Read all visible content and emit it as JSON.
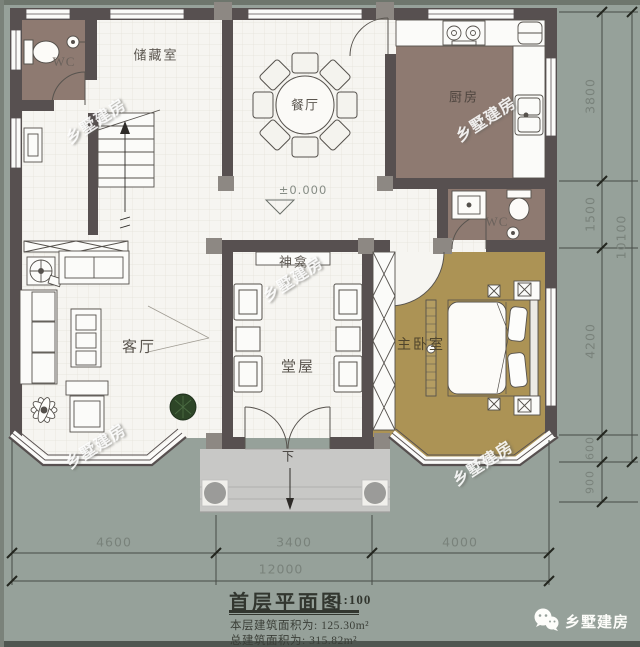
{
  "rooms": {
    "wc_upper": {
      "label": "WC"
    },
    "storage": {
      "label": "储藏室"
    },
    "dining": {
      "label": "餐厅"
    },
    "kitchen": {
      "label": "厨房"
    },
    "wc_master": {
      "label": "WC"
    },
    "shrine": {
      "label": "神龛"
    },
    "hall": {
      "label": "堂屋"
    },
    "living": {
      "label": "客厅"
    },
    "master_bedroom": {
      "label": "主卧室"
    }
  },
  "markers": {
    "level": "±0.000",
    "entry_down": "下"
  },
  "dimensions": {
    "bottom": {
      "segments": [
        "4600",
        "3400",
        "4000"
      ],
      "total": "12000"
    },
    "right": {
      "segments": [
        "3800",
        "1500",
        "4200",
        "600",
        "900"
      ],
      "total": "10100"
    }
  },
  "title_block": {
    "title": "首层平面图",
    "scale": "1:100",
    "floor_area": "本层建筑面积为: 125.30m²",
    "total_area": "总建筑面积为: 315.82m²"
  },
  "watermark": {
    "text": "乡墅建房"
  },
  "logo": {
    "text": "乡墅建房"
  },
  "colors": {
    "background": "#96A19A",
    "wall": "#575050",
    "wet_room_floor": "#8E7A71",
    "bedroom_floor": "#AC9355",
    "tile_floor": "#F6F5F1",
    "porch": "#C8C8C6",
    "dimension_text": "#79827B",
    "plant": "#2D4527"
  }
}
